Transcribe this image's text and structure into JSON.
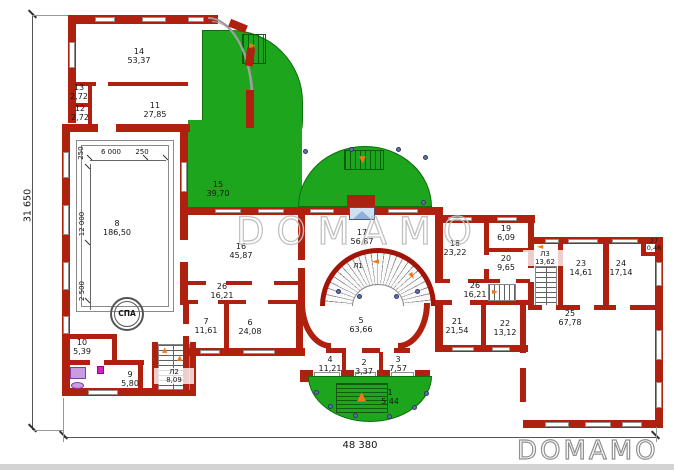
{
  "watermarks": {
    "center": "DOMAMO",
    "corner": "DOMAMO"
  },
  "dimensions": {
    "left_total": "31 650",
    "bottom_total": "48 380"
  },
  "pool_dims": {
    "top_left": "250",
    "top_mid": "6 000",
    "top_right": "250",
    "left": "12 000",
    "bottom_left": "2 500"
  },
  "spa_label": "СПА",
  "rooms": {
    "r1": {
      "num": "1",
      "area": "5,44"
    },
    "r2": {
      "num": "2",
      "area": "3,37"
    },
    "r3": {
      "num": "3",
      "area": "7,57"
    },
    "r4": {
      "num": "4",
      "area": "11,21"
    },
    "r5": {
      "num": "5",
      "area": "63,66"
    },
    "r6": {
      "num": "6",
      "area": "24,08"
    },
    "r7": {
      "num": "7",
      "area": "11,61"
    },
    "r8": {
      "num": "8",
      "area": "186,50"
    },
    "r9": {
      "num": "9",
      "area": "5,80"
    },
    "r10": {
      "num": "10",
      "area": "5,39"
    },
    "r11": {
      "num": "11",
      "area": "27,85"
    },
    "r12": {
      "num": "12",
      "area": "2,72"
    },
    "r13": {
      "num": "13",
      "area": "2,72"
    },
    "r14": {
      "num": "14",
      "area": "53,37"
    },
    "r15": {
      "num": "15",
      "area": "39,70"
    },
    "r16": {
      "num": "16",
      "area": "45,87"
    },
    "r17": {
      "num": "17",
      "area": "56,87"
    },
    "r18": {
      "num": "18",
      "area": "23,22"
    },
    "r19": {
      "num": "19",
      "area": "6,09"
    },
    "r20": {
      "num": "20",
      "area": "9,65"
    },
    "r21": {
      "num": "21",
      "area": "21,54"
    },
    "r22": {
      "num": "22",
      "area": "13,12"
    },
    "r23": {
      "num": "23",
      "area": "14,61"
    },
    "r24": {
      "num": "24",
      "area": "17,14"
    },
    "r25": {
      "num": "25",
      "area": "67,78"
    },
    "r26a": {
      "num": "26",
      "area": "16,21"
    },
    "r26b": {
      "num": "26",
      "area": "16,21"
    },
    "r27": {
      "num": "27",
      "area": "0,46"
    }
  },
  "stairs": {
    "l1": {
      "num": "Л1"
    },
    "l2": {
      "num": "Л2",
      "area": "8,09"
    },
    "l3": {
      "num": "Л3",
      "area": "13,62"
    }
  },
  "colors": {
    "wall": "#b0200f",
    "green": "#1ea51e",
    "arrow": "#f07818",
    "column_dot": "#6272a8",
    "watermark_gray": "#c2c2c2"
  }
}
